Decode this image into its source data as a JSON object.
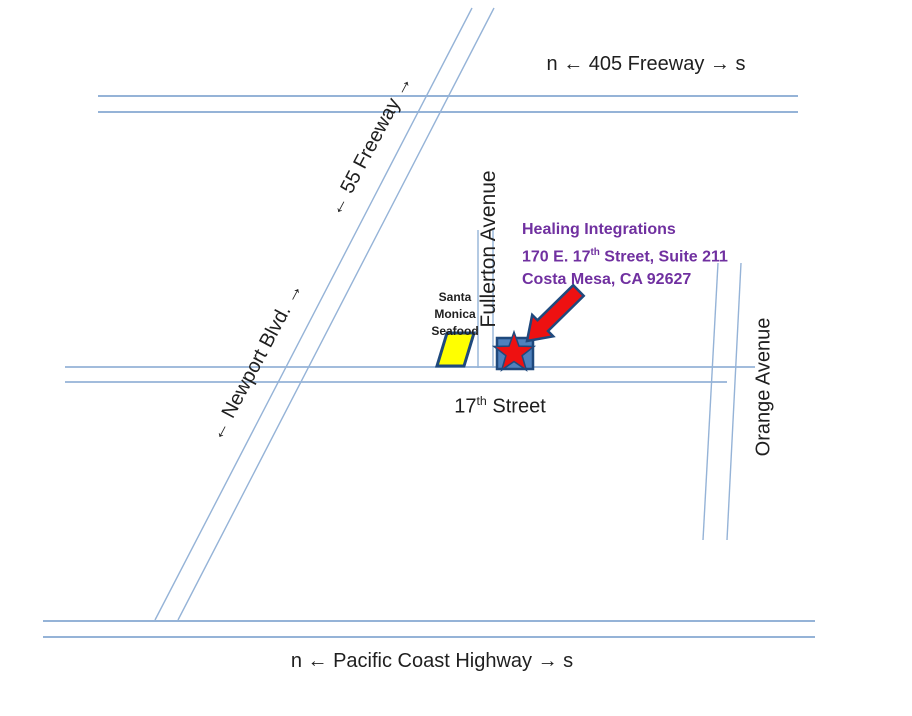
{
  "colors": {
    "road": "#95B3D7",
    "ink": "#1f1f1f",
    "accent-purple": "#7030A0",
    "marker-fill": "#4F81BD",
    "outline-navy": "#1F497D",
    "landmark-yellow": "#FFFF00",
    "arrow-red": "#EE1111"
  },
  "roads": {
    "freeway_405_label": "n ← 405 Freeway → s",
    "freeway_55_label": "← 55 Freeway →",
    "newport_blvd_label": "← Newport Blvd. →",
    "fullerton_label": "Fullerton Avenue",
    "orange_label": "Orange Avenue",
    "pch_label": "n ← Pacific Coast Highway → s",
    "street_17": {
      "num": "17",
      "sup": "th",
      "rest": " Street"
    }
  },
  "destination": {
    "name": "Healing Integrations",
    "address": {
      "pre": "170 E. 17",
      "sup": "th",
      "post": " Street, Suite 211"
    },
    "city": "Costa Mesa, CA 92627"
  },
  "landmark": {
    "lines": [
      "Santa",
      "Monica",
      "Seafood"
    ]
  }
}
